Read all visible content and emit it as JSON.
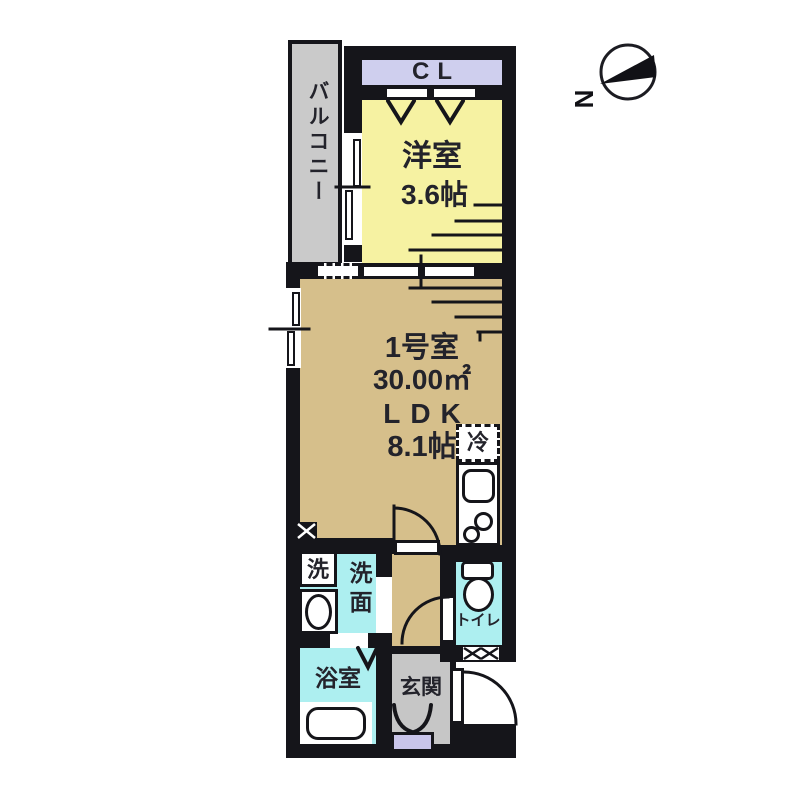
{
  "compass": {
    "north_label": "N"
  },
  "rooms": {
    "balcony": {
      "label": "バルコニー"
    },
    "closet": {
      "label": "CL"
    },
    "western_room": {
      "name": "洋室",
      "size": "3.6帖"
    },
    "main_room": {
      "unit": "1号室",
      "area": "30.00㎡",
      "layout": "LDK",
      "size": "8.1帖"
    },
    "refrigerator": {
      "label": "冷"
    },
    "washer": {
      "label": "洗"
    },
    "washroom": {
      "label": "洗面"
    },
    "bathroom": {
      "label": "浴室"
    },
    "toilet": {
      "label": "トイレ"
    },
    "entrance": {
      "label": "玄関"
    }
  },
  "colors": {
    "wall": "#15151a",
    "ink": "#23232b",
    "yellow": "#f6f2a2",
    "tan": "#d6bf8b",
    "cyan": "#adeff0",
    "lav": "#cfcfee",
    "balgray": "#cacaca",
    "entgray": "#c6c6c6",
    "shoelav": "#c9c5ea"
  }
}
